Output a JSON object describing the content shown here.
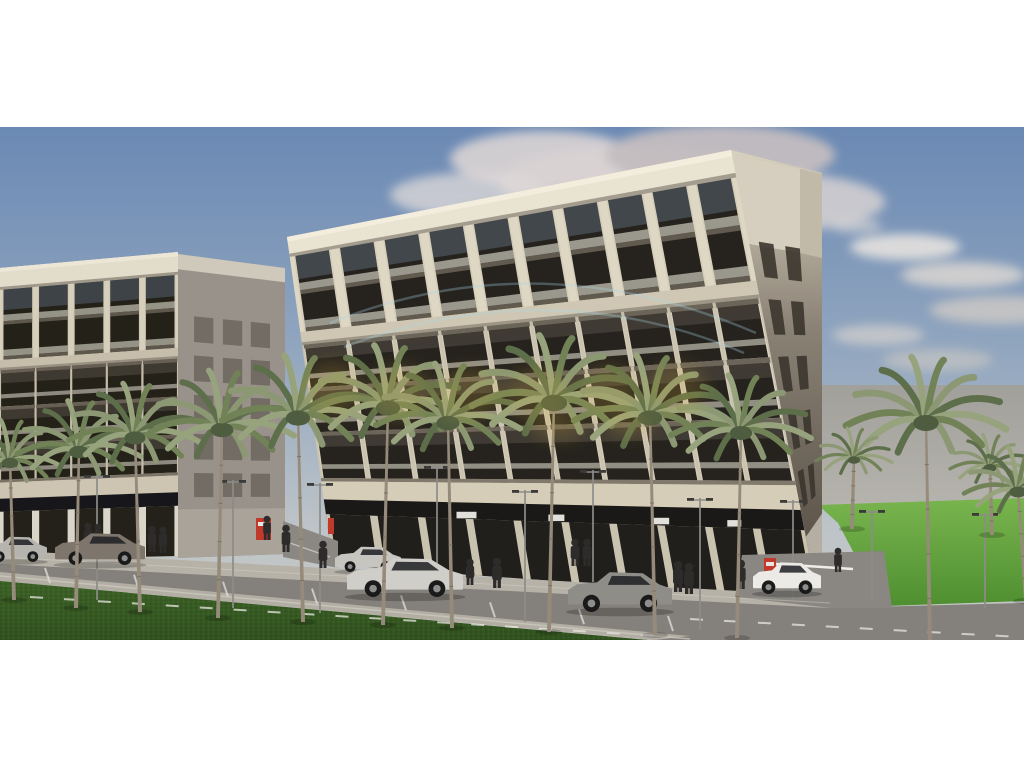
{
  "meta": {
    "type": "architectural-exterior-rendering",
    "subject": "beige mid-rise apartment buildings with ground-floor retail on a palm-lined street",
    "watermark_legible": false
  },
  "scene": {
    "photo": {
      "x": 0,
      "y": 127,
      "w": 1024,
      "h": 513
    },
    "palette": {
      "sky_top": "#6a89b4",
      "sky_mid": "#93a7bf",
      "sky_low": "#bdc4c8",
      "sky_horizon": "#c9c8c2",
      "haze_top": "#a29f99",
      "haze_bottom": "#b6b3ac",
      "road": "#84817c",
      "walkway": "#b7b2a8",
      "sidewalk": "#b2aea4",
      "grass_dark": "#31511f",
      "grass_dark2": "#3d6228",
      "lawn_light": "#79b54e",
      "lawn_deep": "#4f8f31",
      "trunk": "#968b7b",
      "frond": "#718257",
      "people": "#2e2c2a",
      "pole": "#8d8c88",
      "barrier_red": "#c0392b",
      "marking_white": "#e8e7e2",
      "watermark_blue": "#a8d8e8",
      "watermark_gold": "#d7b13e"
    },
    "sky_stops": [
      [
        0,
        "#6a89b4"
      ],
      [
        0.45,
        "#93a7bf"
      ],
      [
        0.78,
        "#bdc4c8"
      ],
      [
        1,
        "#c9c8c2"
      ]
    ],
    "clouds": [
      [
        640,
        55,
        140,
        36,
        "#cfc9cb",
        0.95
      ],
      [
        545,
        32,
        95,
        28,
        "#dad4d4",
        0.9
      ],
      [
        720,
        28,
        115,
        30,
        "#c3bdc0",
        0.95
      ],
      [
        765,
        75,
        120,
        30,
        "#d6d1d1",
        0.85
      ],
      [
        470,
        68,
        80,
        22,
        "#e0dbda",
        0.75
      ],
      [
        595,
        92,
        150,
        24,
        "#c8c2c4",
        0.6
      ],
      [
        905,
        120,
        55,
        13,
        "#e6e2de",
        0.9
      ],
      [
        963,
        148,
        62,
        13,
        "#dbd6d1",
        0.85
      ],
      [
        1000,
        183,
        70,
        14,
        "#d0cbc6",
        0.8
      ],
      [
        878,
        208,
        46,
        10,
        "#d7d3ce",
        0.7
      ],
      [
        938,
        233,
        55,
        11,
        "#cec9c3",
        0.6
      ],
      [
        856,
        99,
        26,
        7,
        "#e2ded9",
        0.6
      ]
    ],
    "haze": {
      "x": 806,
      "y": 258,
      "w": 218,
      "h": 124
    },
    "lawn": {
      "points": "818,378 1024,371 1024,474 884,479 856,430 838,396"
    },
    "buildings": {
      "main": {
        "name": "main-building",
        "corners": [
          [
            287,
            110
          ],
          [
            731,
            23
          ],
          [
            818,
            473
          ],
          [
            333,
            438
          ]
        ],
        "bays": 10,
        "pilasterW": 0.009,
        "cornice_t": 0.061,
        "col": [
          0.061,
          0.29
        ],
        "colMid": 0.177,
        "band": [
          0.29,
          0.329
        ],
        "floors": [
          [
            0.329,
            0.46
          ],
          [
            0.46,
            0.595
          ],
          [
            0.595,
            0.735
          ]
        ],
        "fascia": [
          0.735,
          0.8
        ],
        "glassT": 0.8,
        "signs": [
          [
            0.295,
            20
          ],
          [
            0.483,
            16
          ],
          [
            0.7,
            18
          ],
          [
            0.855,
            14
          ]
        ],
        "signT": 0.835,
        "storeMullW": 0.008,
        "colors": {
          "face": "#d5cdb8",
          "cornice": "#e9e3d2",
          "lip": "#f3eddd",
          "pilaster": "#ded7c4",
          "band": "#cfc7b3",
          "slab": "#6b6458",
          "window": "#26231e",
          "glassSky": "#5b6b78",
          "rail": "#d9d5c7",
          "mullion": "#c9c2af",
          "storeGlass": "#211f1c",
          "strip": "#1a1917",
          "edge": "#ddd6c4",
          "storeMull": "#c9c2af"
        }
      },
      "left": {
        "name": "left-building",
        "corners": [
          [
            0,
            141
          ],
          [
            178,
            125
          ],
          [
            178,
            429
          ],
          [
            0,
            433
          ]
        ],
        "bays": 5,
        "pilasterW": 0.014,
        "cornice_t": 0.075,
        "col": [
          0.075,
          0.315
        ],
        "colMid": 0.195,
        "band": [
          0.315,
          0.35
        ],
        "floors": [
          [
            0.35,
            0.475
          ],
          [
            0.475,
            0.6
          ],
          [
            0.6,
            0.725
          ]
        ],
        "fascia": [
          0.725,
          0.79
        ],
        "glassT": 0.79,
        "signs": [],
        "signT": 0.82,
        "storeMullW": 0.02,
        "colors": {
          "face": "#cdc5b1",
          "cornice": "#e2dccb",
          "lip": "#ece6d6",
          "pilaster": "#d6cfbc",
          "band": "#c6beaa",
          "slab": "#675f54",
          "window": "#242119",
          "glassSky": "#566573",
          "rail": "#d3cfc1",
          "mullion": "#c2bba8",
          "storeGlass": "#232119",
          "strip": "#17161a",
          "edge": null,
          "storeMull": "#d9d5c9"
        }
      },
      "main_side": {
        "name": "main-building-side",
        "corners": [
          [
            731,
            23
          ],
          [
            822,
            46
          ],
          [
            822,
            442
          ],
          [
            818,
            473
          ]
        ],
        "fill": "url(#g-sideMain)",
        "blocks": [
          {
            "points": "733,28 800,42 800,126 733,114",
            "fill": "#d6cfbf"
          },
          {
            "points": "800,42 822,47 822,131 800,126",
            "fill": "#c2baa9"
          }
        ],
        "u_cols": [
          [
            0.14,
            0.34
          ],
          [
            0.5,
            0.7
          ]
        ],
        "t_rows": [
          [
            0.2,
            0.28
          ],
          [
            0.33,
            0.41
          ],
          [
            0.46,
            0.54
          ],
          [
            0.59,
            0.67
          ],
          [
            0.72,
            0.8
          ]
        ],
        "win_fill": "#3b352e",
        "base_strip": {
          "t": [
            0.86,
            1
          ],
          "fill": "#b5afa3"
        }
      },
      "left_side": {
        "name": "left-building-side",
        "corners": [
          [
            178,
            127
          ],
          [
            285,
            141
          ],
          [
            285,
            427
          ],
          [
            178,
            431
          ]
        ],
        "fill": "#99928a",
        "blocks": [],
        "cornice_strip": {
          "t": [
            0,
            0.05
          ],
          "fill": "#cfc9bb"
        },
        "u_cols": [
          [
            0.15,
            0.33
          ],
          [
            0.42,
            0.6
          ],
          [
            0.68,
            0.86
          ]
        ],
        "t_rows": [
          [
            0.2,
            0.285
          ],
          [
            0.33,
            0.415
          ],
          [
            0.46,
            0.545
          ],
          [
            0.59,
            0.675
          ],
          [
            0.72,
            0.8
          ]
        ],
        "win_fill": "#6e6861",
        "base_strip": {
          "t": [
            0.84,
            1
          ],
          "fill": "#a9a399"
        }
      }
    },
    "gap": {
      "points": "283,394 338,414 338,441 283,430",
      "fill": "#8b8883"
    },
    "ground": [
      {
        "name": "storefront-walkway",
        "points": "0,423 830,469 830,481 0,437",
        "fill": "#b7b2a8"
      },
      {
        "name": "road",
        "points": "0,437 830,481 1024,476 1024,513 655,513 0,452",
        "fill": "#84817c"
      },
      {
        "name": "entrance-drive",
        "points": "735,470 742,428 884,424 892,481 830,481",
        "fill": "#8a8782"
      },
      {
        "name": "near-sidewalk",
        "points": "0,445 690,509 655,513 0,454",
        "fill": "#b2aea4"
      }
    ],
    "grass_wedge": {
      "points": "0,454 648,513 0,513"
    },
    "markings": {
      "parking_ticks": {
        "x1": 45,
        "y1": 441,
        "x2": 668,
        "y2": 489,
        "count": 8,
        "dx": 5,
        "dy": 15
      },
      "dash_lines": [
        "M30,470 L660,509",
        "M690,492 L1020,510"
      ],
      "solid_lines": [
        {
          "d": "M0,449 L690,512",
          "color": "#cfccc2",
          "w": 1.5,
          "op": 0.7
        },
        {
          "d": "M0,430 L830,476",
          "color": "#d8d5cc",
          "w": 1,
          "op": 0.45
        },
        {
          "d": "M290,416 L330,430",
          "color": "#e8e7e2",
          "w": 1.2,
          "op": 0.6
        }
      ]
    },
    "accents": [
      {
        "name": "red-banner",
        "x": 328,
        "y": 391,
        "w": 6,
        "h": 16,
        "fill": "#c0392b"
      }
    ],
    "barriers": [
      {
        "name": "parking-barrier-left",
        "box": [
          256,
          391,
          15,
          22
        ]
      },
      {
        "name": "parking-barrier-right",
        "box": [
          764,
          431,
          12,
          21
        ],
        "pole": [
          768,
          452,
          3,
          14
        ],
        "arm": [
          776,
          437,
          853,
          442
        ]
      }
    ],
    "poles": [
      [
        97,
        473,
        125
      ],
      [
        233,
        481,
        128
      ],
      [
        320,
        486,
        130
      ],
      [
        437,
        455,
        116
      ],
      [
        525,
        495,
        132
      ],
      [
        593,
        455,
        112
      ],
      [
        700,
        503,
        132
      ],
      [
        793,
        473,
        100
      ],
      [
        872,
        475,
        92
      ],
      [
        985,
        481,
        95
      ]
    ],
    "people": [
      [
        88,
        422,
        26
      ],
      [
        98,
        421,
        24
      ],
      [
        152,
        425,
        26
      ],
      [
        163,
        426,
        26
      ],
      [
        267,
        413,
        24
      ],
      [
        286,
        425,
        27
      ],
      [
        323,
        441,
        27
      ],
      [
        470,
        458,
        26
      ],
      [
        497,
        461,
        30
      ],
      [
        575,
        439,
        27
      ],
      [
        587,
        439,
        27
      ],
      [
        678,
        465,
        31
      ],
      [
        689,
        467,
        31
      ],
      [
        741,
        462,
        29
      ],
      [
        838,
        445,
        24
      ]
    ],
    "cars": [
      {
        "name": "car-silver-partial",
        "x": -14,
        "y": 408,
        "w": 60,
        "h": 27,
        "color": "#b6b4af"
      },
      {
        "name": "car-suv-gray",
        "x": 56,
        "y": 404,
        "w": 88,
        "h": 34,
        "color": "#7e766c"
      },
      {
        "name": "car-suv-silver",
        "x": 336,
        "y": 418,
        "w": 64,
        "h": 27,
        "color": "#c7c5c0"
      },
      {
        "name": "car-sedan-silver",
        "x": 348,
        "y": 428,
        "w": 114,
        "h": 42,
        "color": "#d0cec9"
      },
      {
        "name": "car-sedan-gray",
        "x": 569,
        "y": 442,
        "w": 102,
        "h": 43,
        "color": "#8f8d88"
      },
      {
        "name": "car-sedan-white",
        "x": 754,
        "y": 433,
        "w": 66,
        "h": 34,
        "color": "#eceae6"
      }
    ],
    "palms": [
      [
        14,
        473,
        333,
        52,
        -4
      ],
      [
        76,
        481,
        322,
        62,
        3
      ],
      [
        140,
        485,
        308,
        66,
        -5
      ],
      [
        218,
        491,
        300,
        72,
        4
      ],
      [
        303,
        495,
        288,
        76,
        -5
      ],
      [
        383,
        498,
        278,
        76,
        5
      ],
      [
        452,
        501,
        293,
        72,
        -4
      ],
      [
        549,
        505,
        273,
        82,
        5
      ],
      [
        655,
        508,
        288,
        76,
        -5
      ],
      [
        737,
        511,
        303,
        70,
        4
      ],
      [
        930,
        516,
        293,
        80,
        -4
      ],
      [
        852,
        402,
        330,
        38,
        2
      ],
      [
        992,
        408,
        338,
        40,
        -2
      ],
      [
        1026,
        474,
        362,
        54,
        -8
      ]
    ],
    "watermark": {
      "arcs": [
        "M330,196 C470,140 612,144 756,206",
        "M344,220 C482,168 618,172 744,226"
      ],
      "gold_blobs": [
        [
          332,
          262,
          30,
          28
        ],
        [
          400,
          266,
          32,
          28
        ],
        [
          468,
          268,
          34,
          28
        ],
        [
          538,
          268,
          34,
          28
        ],
        [
          608,
          266,
          32,
          28
        ],
        [
          676,
          262,
          30,
          26
        ],
        [
          560,
          300,
          26,
          14
        ],
        [
          630,
          298,
          24,
          12
        ]
      ]
    }
  }
}
